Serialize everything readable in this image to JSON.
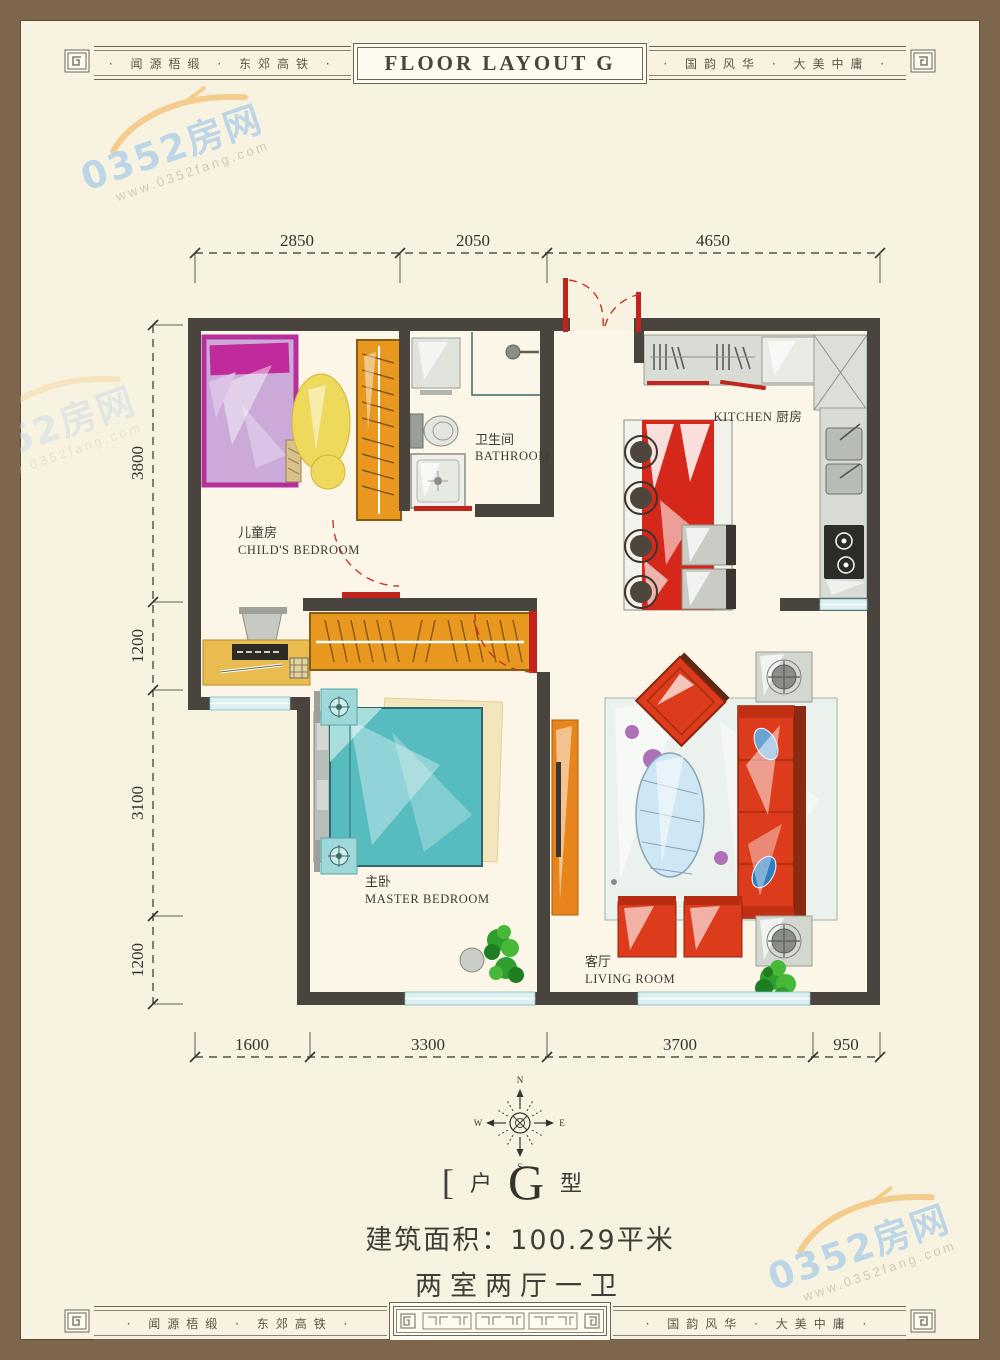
{
  "banner": {
    "left_text": "· 闻源梧缎 · 东郊高铁 ·",
    "center_title": "FLOOR LAYOUT G",
    "right_text": "· 国韵风华 · 大美中庸 ·"
  },
  "watermark": {
    "name": "0352房网",
    "url": "www.0352fang.com"
  },
  "dimensions": {
    "top": [
      "2850",
      "2050",
      "4650"
    ],
    "left": [
      "3800",
      "1200",
      "3100",
      "1200"
    ],
    "bottom": [
      "1600",
      "3300",
      "3700",
      "950"
    ]
  },
  "rooms": {
    "childs_bedroom": {
      "zh": "儿童房",
      "en": "CHILD'S BEDROOM"
    },
    "bathroom": {
      "zh": "卫生间",
      "en": "BATHROOM"
    },
    "kitchen": {
      "label": "KITCHEN 厨房"
    },
    "master_bedroom": {
      "zh": "主卧",
      "en": "MASTER BEDROOM"
    },
    "living_room": {
      "zh": "客厅",
      "en": "LIVING ROOM"
    }
  },
  "compass": {
    "n": "N",
    "e": "E",
    "s": "S",
    "w": "W"
  },
  "unit": {
    "bracket_left": "[",
    "prefix": "户",
    "letter": "G",
    "suffix": "型",
    "area_text": "建筑面积：100.29平米",
    "layout_text": "两室两厅一卫",
    "star": "★"
  },
  "colors": {
    "wall": "#4a443e",
    "accent_red": "#d93a1c",
    "accent_orange": "#e8961f",
    "bed_teal": "#57bcc0",
    "bed_magenta": "#c2369e",
    "window_teal": "#d9eef0",
    "watermark_blue": "#bcd6e8",
    "frame_brown": "#7c664c",
    "paper": "#f8f2e0"
  }
}
